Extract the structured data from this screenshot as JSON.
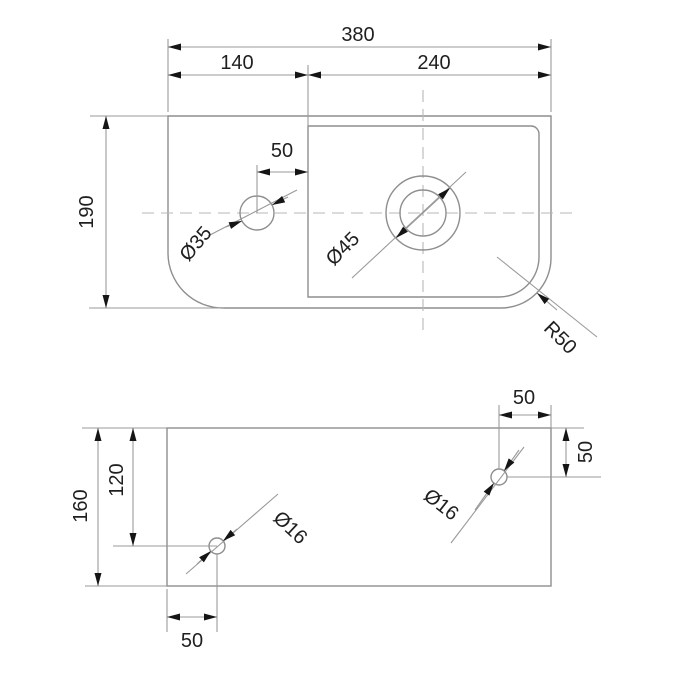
{
  "title": "Technical dimension drawing — basin top and mounting views",
  "colors": {
    "background": "#ffffff",
    "line": "#8e8e8e",
    "dim_line": "#9a9a9a",
    "centerline": "#b7b7b7",
    "text": "#1f1f1f",
    "arrow": "#151515"
  },
  "top_view": {
    "dim_total_width": "380",
    "dim_left_section": "140",
    "dim_right_section": "240",
    "dim_overall_height": "190",
    "dim_small_hole_offset": "50",
    "label_small_hole_diameter": "Ø35",
    "label_drain_diameter": "Ø45",
    "label_corner_radius": "R50"
  },
  "bottom_view": {
    "dim_overall_height": "160",
    "dim_left_hole_from_top": "120",
    "dim_left_hole_from_edge": "50",
    "dim_right_hole_from_edge": "50",
    "dim_right_hole_from_top": "50",
    "label_left_hole_diameter": "Ø16",
    "label_right_hole_diameter": "Ø16"
  }
}
